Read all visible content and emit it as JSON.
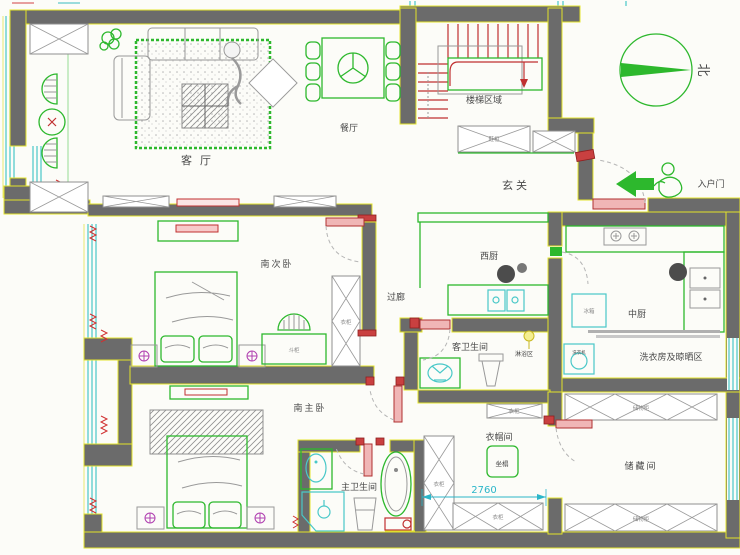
{
  "meta": {
    "type": "residential floor plan drawing"
  },
  "colors": {
    "wall": "#6b6b6b",
    "wall_outline": "#e3e32a",
    "furniture": "#2db82d",
    "door": "#c03030",
    "window": "#49c8c8",
    "dimension": "#2bb6c9",
    "label": "#4a4a4a"
  },
  "rooms": {
    "living_room": "客厅",
    "dining_room": "餐厅",
    "stair_area": "楼梯区域",
    "foyer": "玄关",
    "west_kitchen": "西厨",
    "main_kitchen": "中厨",
    "laundry_drying": "洗衣房及晾晒区",
    "corridor": "过廊",
    "south_second_bedroom": "南次卧",
    "guest_bathroom": "客卫生间",
    "shower_zone": "淋浴区",
    "south_master_bedroom": "南主卧",
    "master_bathroom": "主卫生间",
    "cloakroom": "衣帽间",
    "storage_room": "储藏间"
  },
  "annotations": {
    "entry_door": "入户门",
    "north": "北",
    "seat": "坐榻"
  },
  "furniture": {
    "shoe_cabinet": "鞋柜",
    "wardrobe": "衣柜",
    "chest_of_drawers": "斗柜",
    "refrigerator": "冰箱",
    "washing_machine": "洗衣机",
    "storage_cabinet": "储物柜"
  },
  "dimensions": {
    "cloakroom_width": "2760"
  }
}
